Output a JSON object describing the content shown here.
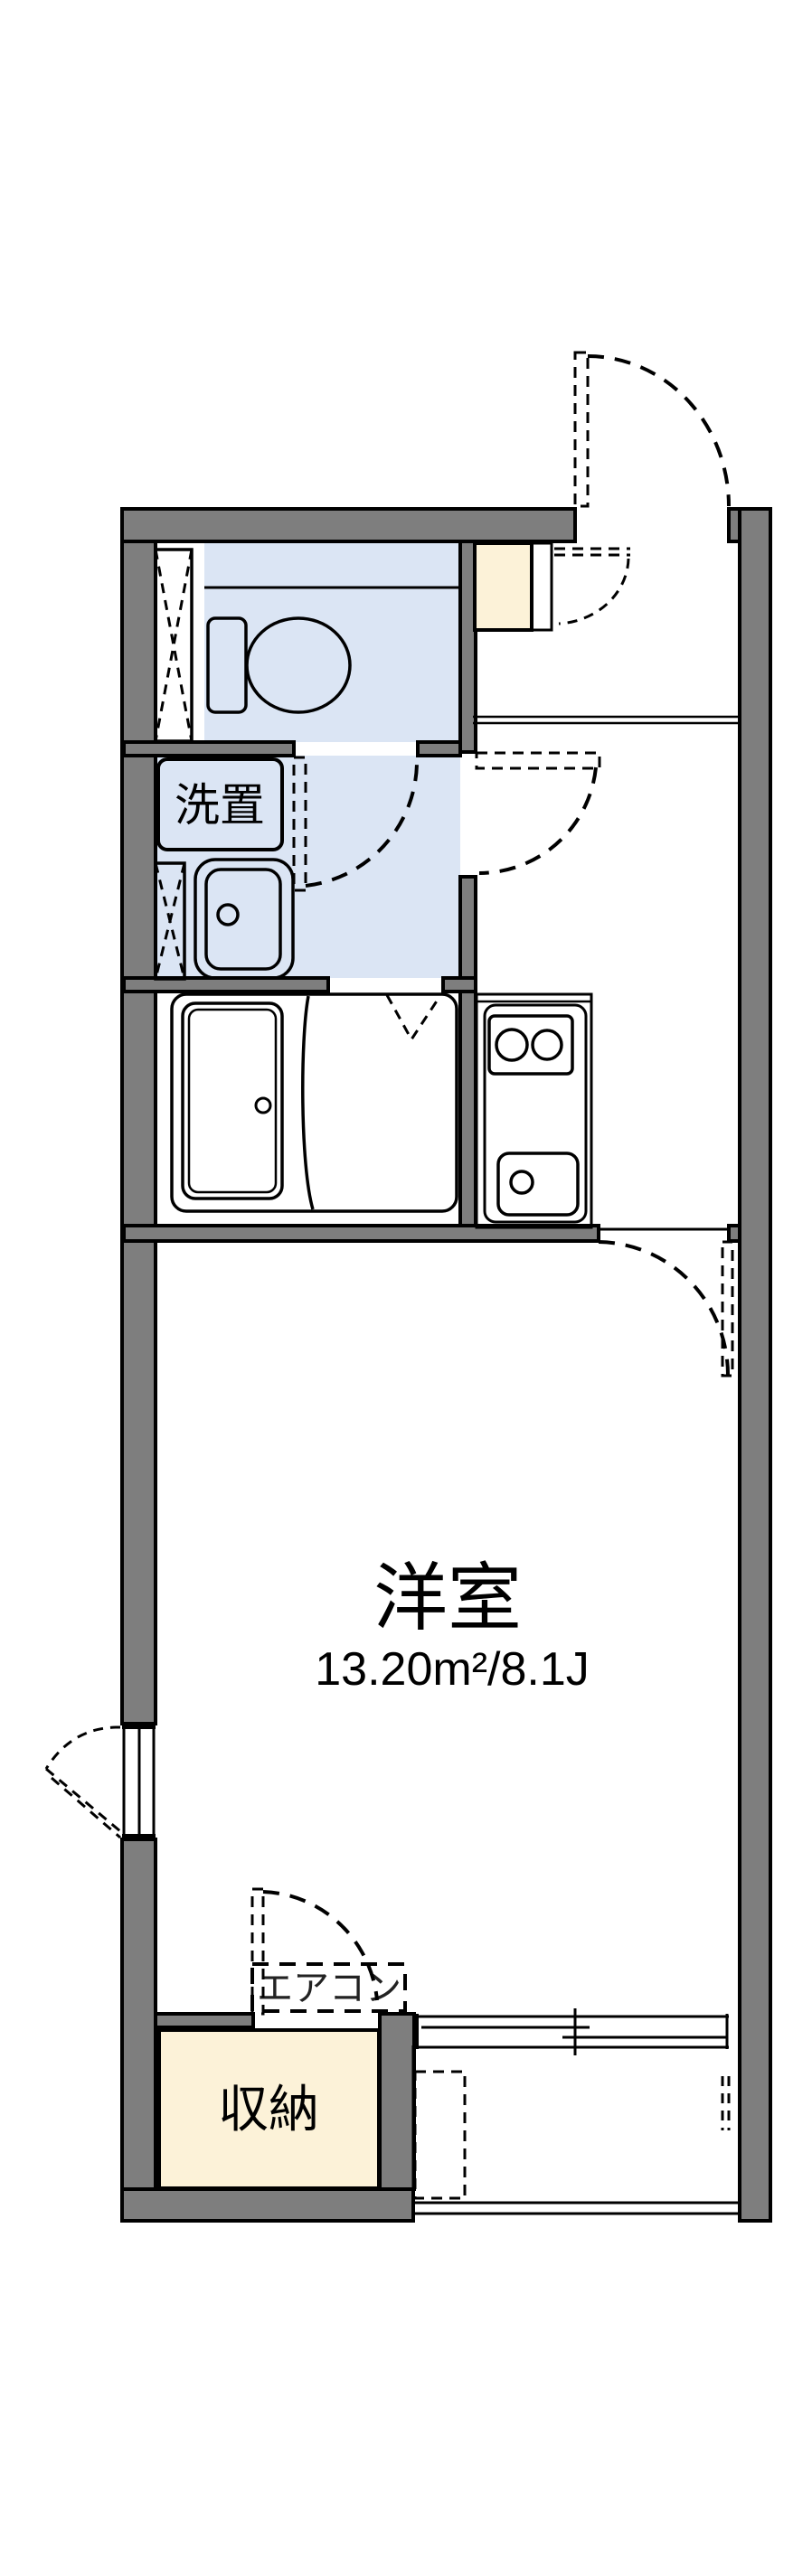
{
  "floorplan": {
    "living_room": {
      "label": "洋室",
      "area": "13.20m²/8.1J"
    },
    "laundry": {
      "label": "洗置"
    },
    "storage": {
      "label": "収納"
    },
    "air_conditioner": {
      "label": "エアコン"
    },
    "colors": {
      "wall": "#7e7e7e",
      "water_area": "#dbe5f4",
      "storage_fill": "#fcf2d8",
      "line": "#000000",
      "background": "#ffffff"
    }
  }
}
